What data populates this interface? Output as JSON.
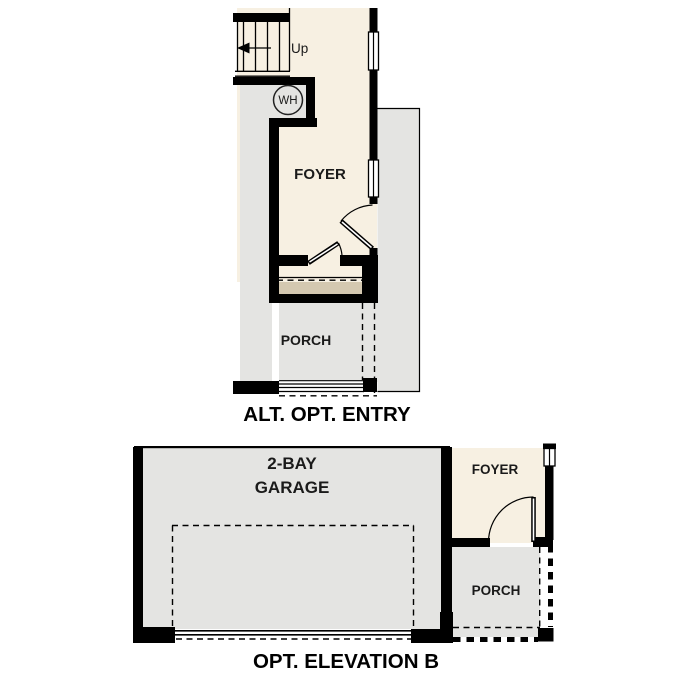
{
  "colors": {
    "interior_cream": "#f7f0e2",
    "exterior_gray": "#e4e4e2",
    "step_tan": "#d4c8b0",
    "wall_black": "#000000",
    "window_white": "#ffffff"
  },
  "plans": {
    "alt_entry": {
      "caption": "ALT. OPT. ENTRY",
      "labels": {
        "foyer": "FOYER",
        "porch": "PORCH",
        "stairs_up": "Up",
        "water_heater": "WH"
      }
    },
    "elevation_b": {
      "caption": "OPT. ELEVATION B",
      "labels": {
        "garage_line1": "2-BAY",
        "garage_line2": "GARAGE",
        "foyer": "FOYER",
        "porch": "PORCH"
      }
    }
  }
}
